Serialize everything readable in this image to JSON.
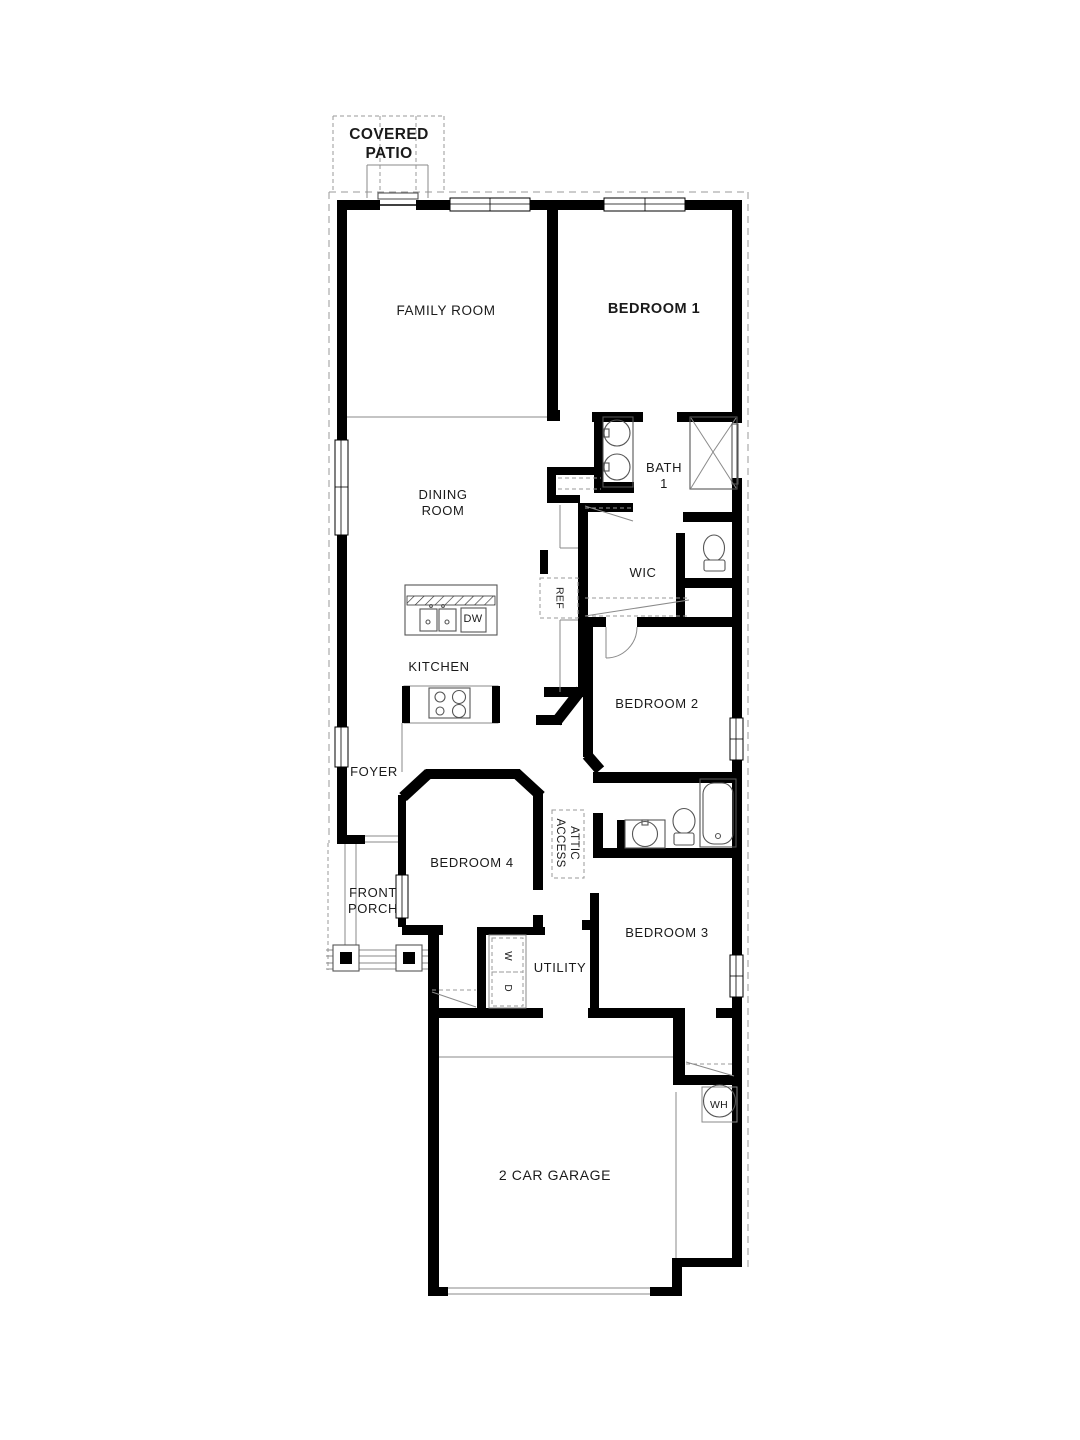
{
  "title": "Floor Plan",
  "colors": {
    "background": "#ffffff",
    "wall": "#000000",
    "thin_line": "#8a8a8a",
    "dashed_line": "#9a9a9a",
    "fixture_line": "#555555",
    "text": "#1a1a1a"
  },
  "labels": [
    {
      "id": "covered-patio",
      "lines": [
        "COVERED",
        "PATIO"
      ],
      "x": 389,
      "y": 126,
      "size": 15.5,
      "bold": true,
      "rot": false,
      "ls": 0.4
    },
    {
      "id": "family-room",
      "lines": [
        "FAMILY ROOM"
      ],
      "x": 446,
      "y": 303,
      "size": 13.5,
      "bold": false,
      "rot": false,
      "ls": 0.6
    },
    {
      "id": "bedroom-1",
      "lines": [
        "BEDROOM 1"
      ],
      "x": 654,
      "y": 301,
      "size": 14.5,
      "bold": true,
      "rot": false,
      "ls": 0.5
    },
    {
      "id": "bath-1",
      "lines": [
        "BATH",
        "1"
      ],
      "x": 664,
      "y": 460,
      "size": 13,
      "bold": false,
      "rot": false,
      "ls": 0.6
    },
    {
      "id": "dining-room",
      "lines": [
        "DINING",
        "ROOM"
      ],
      "x": 443,
      "y": 487,
      "size": 13,
      "bold": false,
      "rot": false,
      "ls": 0.6
    },
    {
      "id": "wic",
      "lines": [
        "WIC"
      ],
      "x": 643,
      "y": 565,
      "size": 13,
      "bold": false,
      "rot": false,
      "ls": 0.6
    },
    {
      "id": "ref",
      "lines": [
        "REF"
      ],
      "x": 559,
      "y": 598,
      "size": 10.5,
      "bold": false,
      "rot": true,
      "ls": 0.3
    },
    {
      "id": "dw",
      "lines": [
        "DW"
      ],
      "x": 473,
      "y": 613,
      "size": 11,
      "bold": false,
      "rot": false,
      "ls": 0.3
    },
    {
      "id": "kitchen",
      "lines": [
        "KITCHEN"
      ],
      "x": 439,
      "y": 659,
      "size": 13,
      "bold": false,
      "rot": false,
      "ls": 0.6
    },
    {
      "id": "bedroom-2",
      "lines": [
        "BEDROOM 2"
      ],
      "x": 657,
      "y": 696,
      "size": 13,
      "bold": false,
      "rot": false,
      "ls": 0.6
    },
    {
      "id": "foyer",
      "lines": [
        "FOYER"
      ],
      "x": 374,
      "y": 764,
      "size": 13,
      "bold": false,
      "rot": false,
      "ls": 0.6
    },
    {
      "id": "attic-access",
      "lines": [
        "ATTIC",
        "ACCESS"
      ],
      "x": 567,
      "y": 843,
      "size": 11.5,
      "bold": false,
      "rot": true,
      "ls": 0.3
    },
    {
      "id": "bedroom-4",
      "lines": [
        "BEDROOM 4"
      ],
      "x": 472,
      "y": 855,
      "size": 13,
      "bold": false,
      "rot": false,
      "ls": 0.6
    },
    {
      "id": "front-porch",
      "lines": [
        "FRONT",
        "PORCH"
      ],
      "x": 373,
      "y": 885,
      "size": 13,
      "bold": false,
      "rot": false,
      "ls": 0.6
    },
    {
      "id": "utility",
      "lines": [
        "UTILITY"
      ],
      "x": 560,
      "y": 960,
      "size": 13,
      "bold": false,
      "rot": false,
      "ls": 0.6
    },
    {
      "id": "washer",
      "lines": [
        "W"
      ],
      "x": 507,
      "y": 956,
      "size": 10,
      "bold": false,
      "rot": true,
      "ls": 0
    },
    {
      "id": "dryer",
      "lines": [
        "D"
      ],
      "x": 507,
      "y": 988,
      "size": 10,
      "bold": false,
      "rot": true,
      "ls": 0
    },
    {
      "id": "bedroom-3",
      "lines": [
        "BEDROOM 3"
      ],
      "x": 667,
      "y": 925,
      "size": 13,
      "bold": false,
      "rot": false,
      "ls": 0.6
    },
    {
      "id": "two-car-garage",
      "lines": [
        "2 CAR GARAGE"
      ],
      "x": 555,
      "y": 1167,
      "size": 14,
      "bold": false,
      "rot": false,
      "ls": 0.6
    },
    {
      "id": "water-heater",
      "lines": [
        "WH"
      ],
      "x": 719,
      "y": 1099,
      "size": 10.5,
      "bold": false,
      "rot": false,
      "ls": 0.2
    }
  ]
}
